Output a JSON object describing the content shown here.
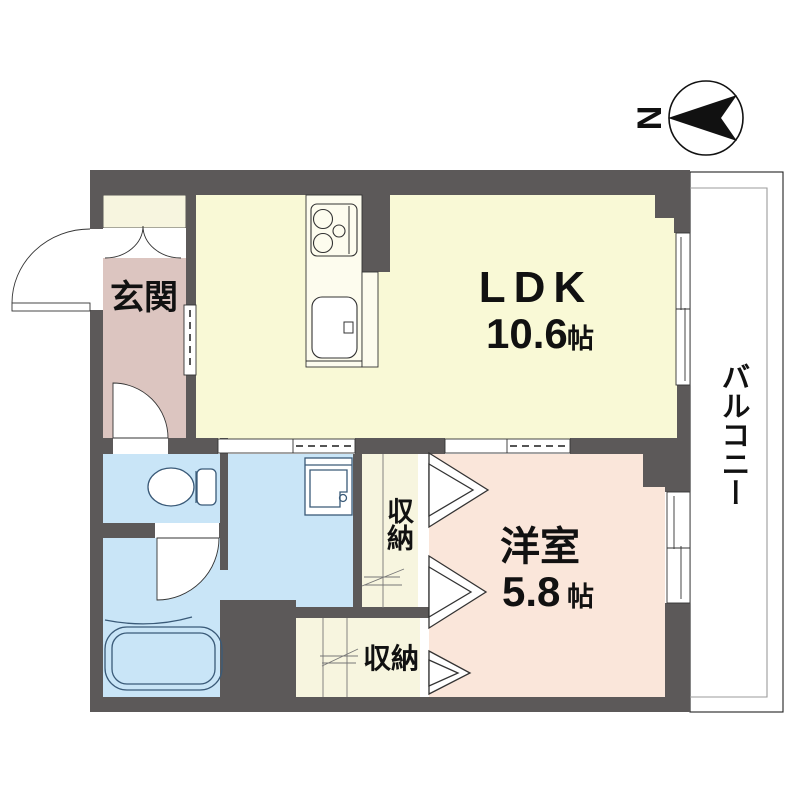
{
  "page": {
    "type": "apartment-floor-plan",
    "background": "#ffffff"
  },
  "compass": {
    "north_label": "N"
  },
  "labels": {
    "entrance": "玄関",
    "ldk": "LDK",
    "ldk_area_value": "10.6",
    "ldk_area_unit": "帖",
    "western_room": "洋室",
    "western_room_area_value": "5.8",
    "western_room_area_unit": "帖",
    "storage_upper": "収納",
    "storage_lower": "収納",
    "balcony": "バルコニー"
  },
  "colors": {
    "wall": "#5c5959",
    "ldk_floor": "#f9f9d6",
    "entrance_floor": "#dcc5c0",
    "wet_area_floor": "#c9e5f7",
    "western_room_floor": "#fae6da",
    "storage_floor": "#f7f5df",
    "balcony_floor": "#ffffff",
    "fixture_line": "#3a5a78",
    "text": "#111111"
  }
}
